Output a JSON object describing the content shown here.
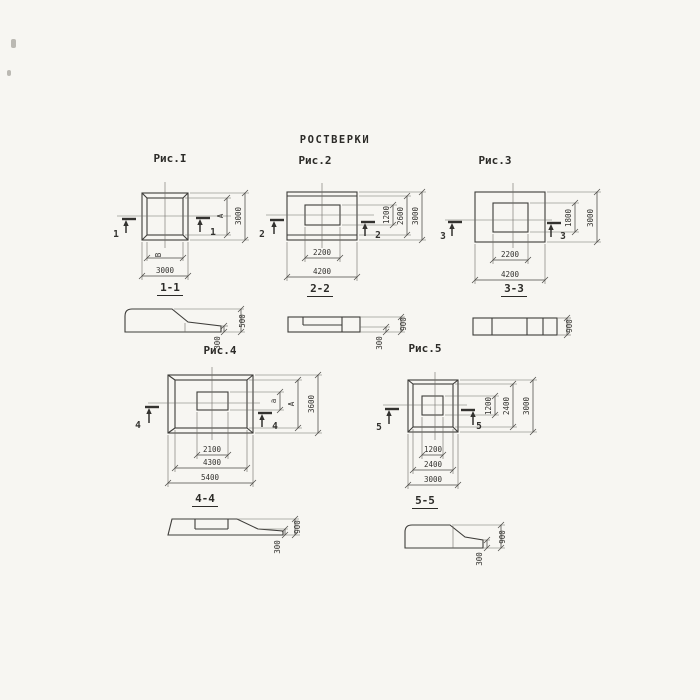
{
  "sheet": {
    "title": "РОСТВЕРКИ",
    "background": "#f7f6f2",
    "line_color": "#3e3d3a"
  },
  "figures": {
    "fig1": {
      "caption": "Рис.I",
      "section_caption": "1-1",
      "cut_label": "1",
      "plan_dims": {
        "inner_width": "В",
        "outer_width": "3000",
        "inner_height": "А",
        "outer_height": "3000"
      },
      "section_dims": {
        "total_height": "500",
        "edge_height": "300"
      }
    },
    "fig2": {
      "caption": "Рис.2",
      "section_caption": "2-2",
      "cut_label": "2",
      "plan_dims": {
        "opening_width": "2200",
        "outer_width": "4200",
        "opening_height": "1200",
        "mid_height": "2600",
        "outer_height": "3000"
      },
      "section_dims": {
        "total_height": "900",
        "edge_height": "300"
      }
    },
    "fig3": {
      "caption": "Рис.3",
      "section_caption": "3-3",
      "cut_label": "3",
      "plan_dims": {
        "opening_width": "2200",
        "outer_width": "4200",
        "opening_height": "1800",
        "outer_height": "3000"
      },
      "section_dims": {
        "total_height": "900"
      }
    },
    "fig4": {
      "caption": "Рис.4",
      "section_caption": "4-4",
      "cut_label": "4",
      "plan_dims": {
        "opening_width": "2100",
        "mid_width": "4300",
        "outer_width": "5400",
        "opening_height": "а",
        "mid_height": "А",
        "outer_height": "3600"
      },
      "section_dims": {
        "total_height": "900",
        "edge_height": "300"
      }
    },
    "fig5": {
      "caption": "Рис.5",
      "section_caption": "5-5",
      "cut_label": "5",
      "plan_dims": {
        "opening_width": "1200",
        "mid_width": "2400",
        "outer_width": "3000",
        "opening_height": "1200",
        "mid_height": "2400",
        "outer_height": "3000"
      },
      "section_dims": {
        "total_height": "900",
        "edge_height": "300"
      }
    }
  }
}
